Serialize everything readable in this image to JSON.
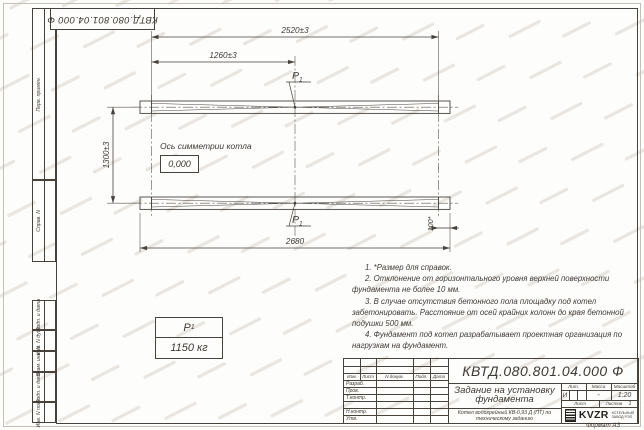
{
  "sheet": {
    "corner_stamp_text": "КВТД.080.801.04.000 Ф",
    "format_note": "Формат А3"
  },
  "margin": {
    "labels": [
      "Перв. примен.",
      "Справ. N",
      "Подп. и дата",
      "Инв. N дубл.",
      "Взам. инв. N",
      "Подп. и дата",
      "Инв. N подл."
    ]
  },
  "drawing": {
    "dim_total_top": "2520±3",
    "dim_half_top": "1260±3",
    "dim_vertical": "1300±3",
    "dim_total_bottom": "2680",
    "dim_overhang": "100*",
    "axis_label": "Ось симметрии котла",
    "level_mark": "0,000",
    "load_point": "P",
    "load_point_sub": "1"
  },
  "load_table": {
    "name": "P",
    "name_sub": "1",
    "value": "1150 кг"
  },
  "notes": [
    "1. *Размер для справок.",
    "2. Отклонение от горизонтального уровня верхней поверхности фундамента не более 10 мм.",
    "3. В случае отсутствия бетонного пола площадку под котел забетонировать. Расстояние от осей крайних колонн до края бетонной подушки 500 мм.",
    "4. Фундамент под котел разрабатывает проектная организация по нагрузкам на фундамент."
  ],
  "title_block": {
    "doc_number": "КВТД.080.801.04.000 Ф",
    "title": "Задание на установку фундамента",
    "subtitle": "Котел водогрейный КВ-0,93 Д (ПТ) по техническому заданию",
    "header": [
      "Изм.",
      "Лист",
      "N докум.",
      "Подп.",
      "Дата"
    ],
    "row_labels": [
      "Разраб.",
      "Пров.",
      "Т.контр.",
      "",
      "Н.контр.",
      "Утв."
    ],
    "lit_label": "Лит.",
    "mass_label": "Масса",
    "scale_label": "Масштаб",
    "lit_value": "И",
    "mass_value": "-",
    "scale_value": "1:20",
    "sheet_label": "Лист",
    "sheets_label": "Листов",
    "sheets_value": "1",
    "logo_text": "KVZR",
    "logo_caption1": "КОТЕЛЬНЫЙ",
    "logo_caption2": "ЗАВОД РЭП"
  }
}
